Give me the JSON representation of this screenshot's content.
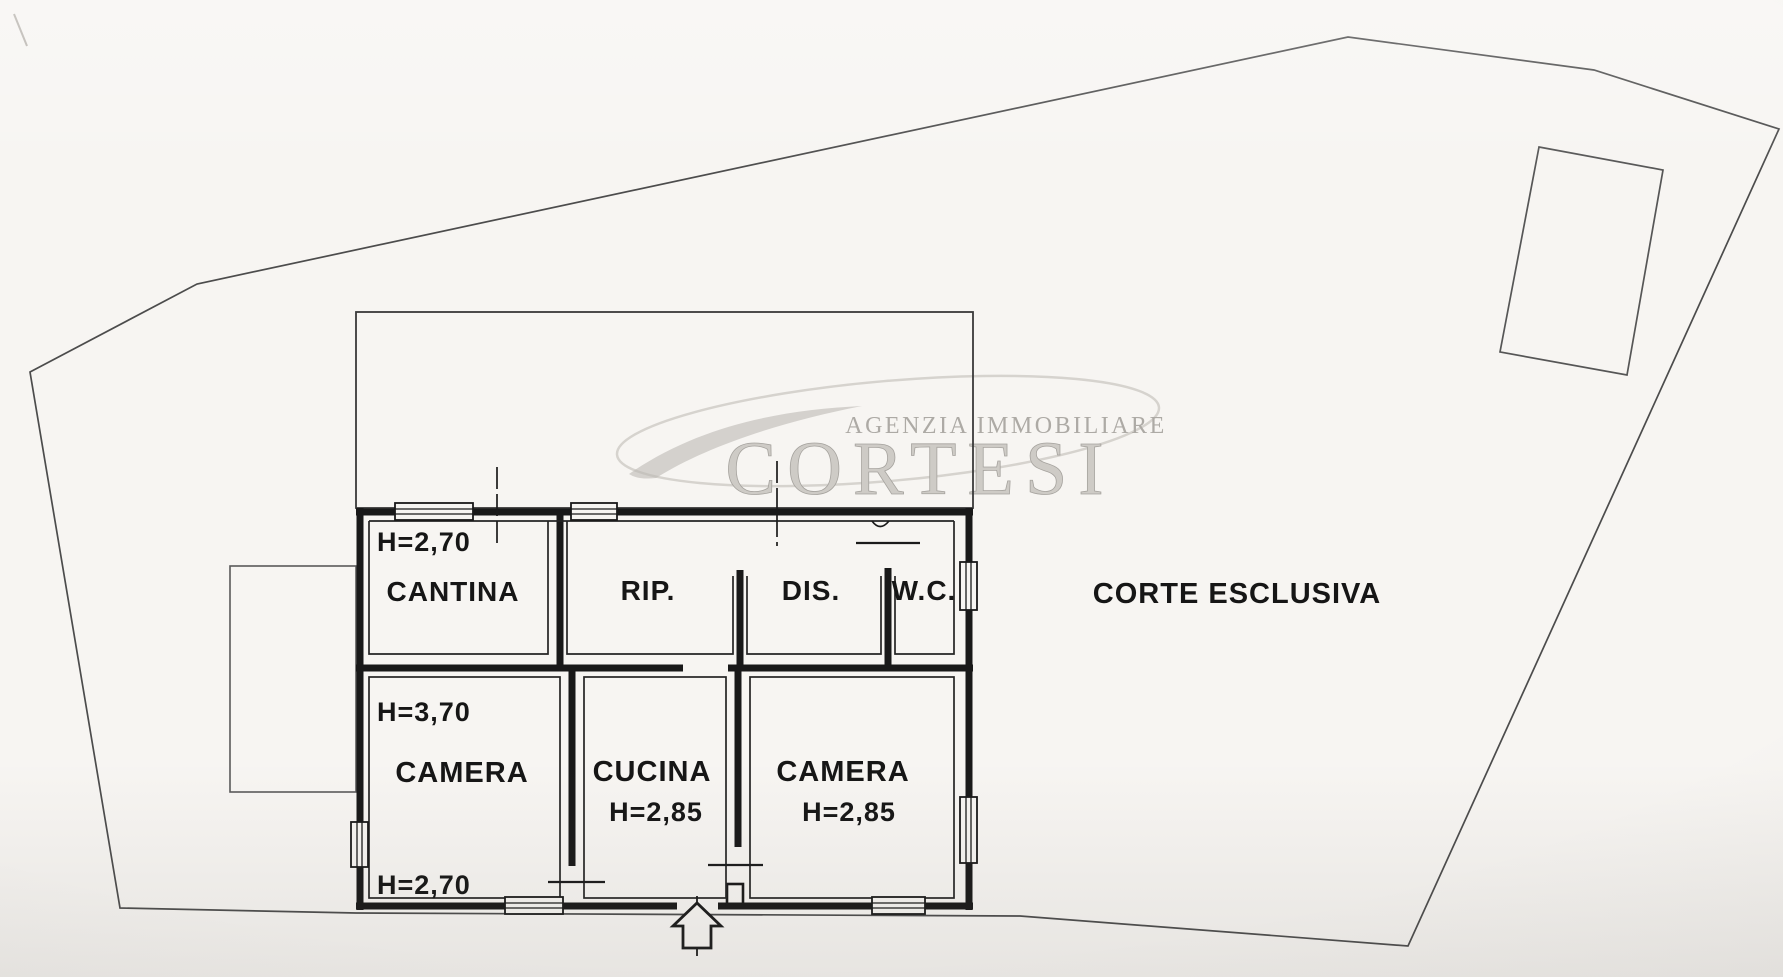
{
  "document": {
    "kind": "scanned floor plan",
    "language": "it"
  },
  "watermark": {
    "line1": "AGENZIA IMMOBILIARE",
    "line2": "CORTESI"
  },
  "outdoor": {
    "label": "CORTE ESCLUSIVA"
  },
  "rooms": {
    "cantina": {
      "label": "CANTINA",
      "height": "H=2,70"
    },
    "rip": {
      "label": "RIP."
    },
    "dis": {
      "label": "DIS."
    },
    "wc": {
      "label": "W.C."
    },
    "camera1": {
      "label": "CAMERA",
      "height_max": "H=3,70",
      "height_min": "H=2,70"
    },
    "cucina": {
      "label": "CUCINA",
      "height": "H=2,85"
    },
    "camera2": {
      "label": "CAMERA",
      "height": "H=2,85"
    }
  },
  "colors": {
    "paper": "#f7f5f2",
    "ink": "#1b1b1b",
    "boundary_line": "#4c4c4c",
    "watermark_gray": "#b3b0ac"
  }
}
